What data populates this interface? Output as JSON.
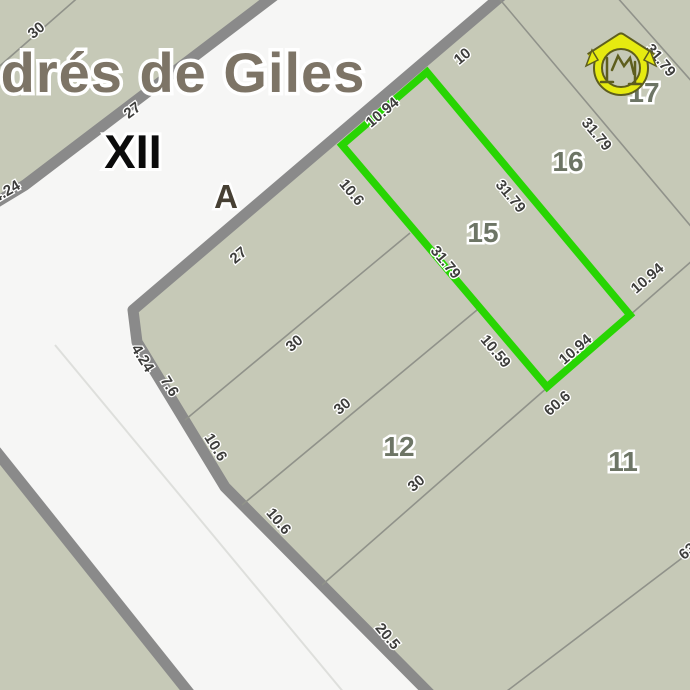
{
  "map": {
    "place_name_fragment": "drés de Giles",
    "zone_roman": "XII",
    "block_letter": "A",
    "colors": {
      "road": "#f6f6f5",
      "block_fill": "#c6c9b7",
      "road_casing": "#8a8a8a",
      "parcel_line": "#90928a",
      "highlight_green": "#28d503",
      "title_text": "#7d7466",
      "dimension_text": "#3d3d3b",
      "parcel_number_text": "#6d7565",
      "logo_yellow": "#e6ea10"
    }
  },
  "parcels": [
    {
      "number": "15",
      "highlighted": true
    },
    {
      "number": "16",
      "highlighted": false
    },
    {
      "number": "17",
      "highlighted": false
    },
    {
      "number": "11",
      "highlighted": false
    },
    {
      "number": "12",
      "highlighted": false
    }
  ],
  "dimensions": [
    {
      "text": "30"
    },
    {
      "text": "27"
    },
    {
      "text": "4.24"
    },
    {
      "text": "27"
    },
    {
      "text": "10.94"
    },
    {
      "text": "10"
    },
    {
      "text": "10.6"
    },
    {
      "text": "31.79"
    },
    {
      "text": "10.59"
    },
    {
      "text": "31.79"
    },
    {
      "text": "31.79"
    },
    {
      "text": "31.79"
    },
    {
      "text": "10.94"
    },
    {
      "text": "10.94"
    },
    {
      "text": "60.6"
    },
    {
      "text": "30"
    },
    {
      "text": "30"
    },
    {
      "text": "30"
    },
    {
      "text": "10.6"
    },
    {
      "text": "10.6"
    },
    {
      "text": "7.6"
    },
    {
      "text": "4.24"
    },
    {
      "text": "20.5"
    },
    {
      "text": "63"
    }
  ]
}
